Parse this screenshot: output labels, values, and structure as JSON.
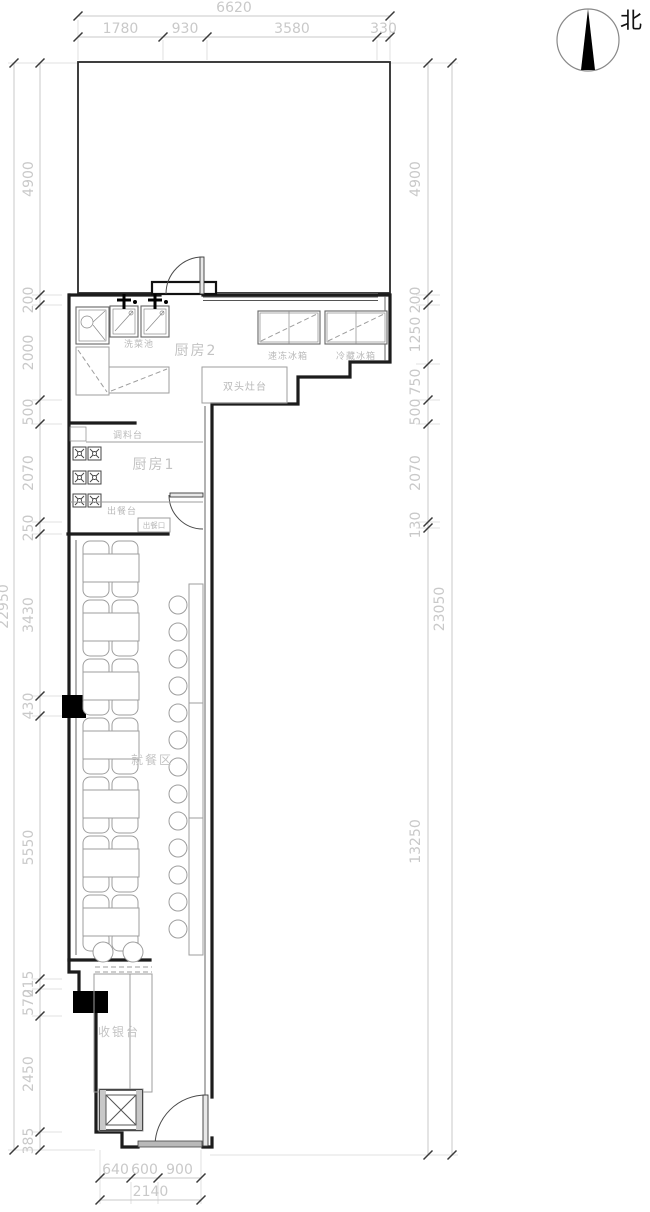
{
  "compass": {
    "north_label": "北"
  },
  "rooms": {
    "kitchen2": "厨房2",
    "kitchen1": "厨房1",
    "dining": "就餐区",
    "cashier": "收银台"
  },
  "fixtures": {
    "wash_sink": "洗菜池",
    "freezer": "速冻冰箱",
    "fridge": "冷藏冰箱",
    "double_stove": "双头灶台",
    "seasoning_counter": "调料台",
    "serving_counter": "出餐台",
    "serving_hatch": "出餐口"
  },
  "dimensions": {
    "top": {
      "total": "6620",
      "segments": [
        "1780",
        "930",
        "3580",
        "330"
      ]
    },
    "left": {
      "total": "22950",
      "segments": [
        "4900",
        "200",
        "2000",
        "500",
        "2070",
        "250",
        "3430",
        "430",
        "5550",
        "215",
        "570",
        "2450",
        "385"
      ]
    },
    "right": {
      "total": "23050",
      "segments": [
        "4900",
        "200",
        "1250",
        "750",
        "500",
        "2070",
        "130",
        "13250"
      ]
    },
    "bottom": {
      "total": "2140",
      "segments": [
        "640",
        "600",
        "900"
      ]
    }
  },
  "colors": {
    "wall": "#1c1c1c",
    "furniture_line": "#9e9e9e",
    "dimension_line": "#c9c9c9",
    "tick": "#3a3a3a",
    "column_fill": "#000000"
  }
}
